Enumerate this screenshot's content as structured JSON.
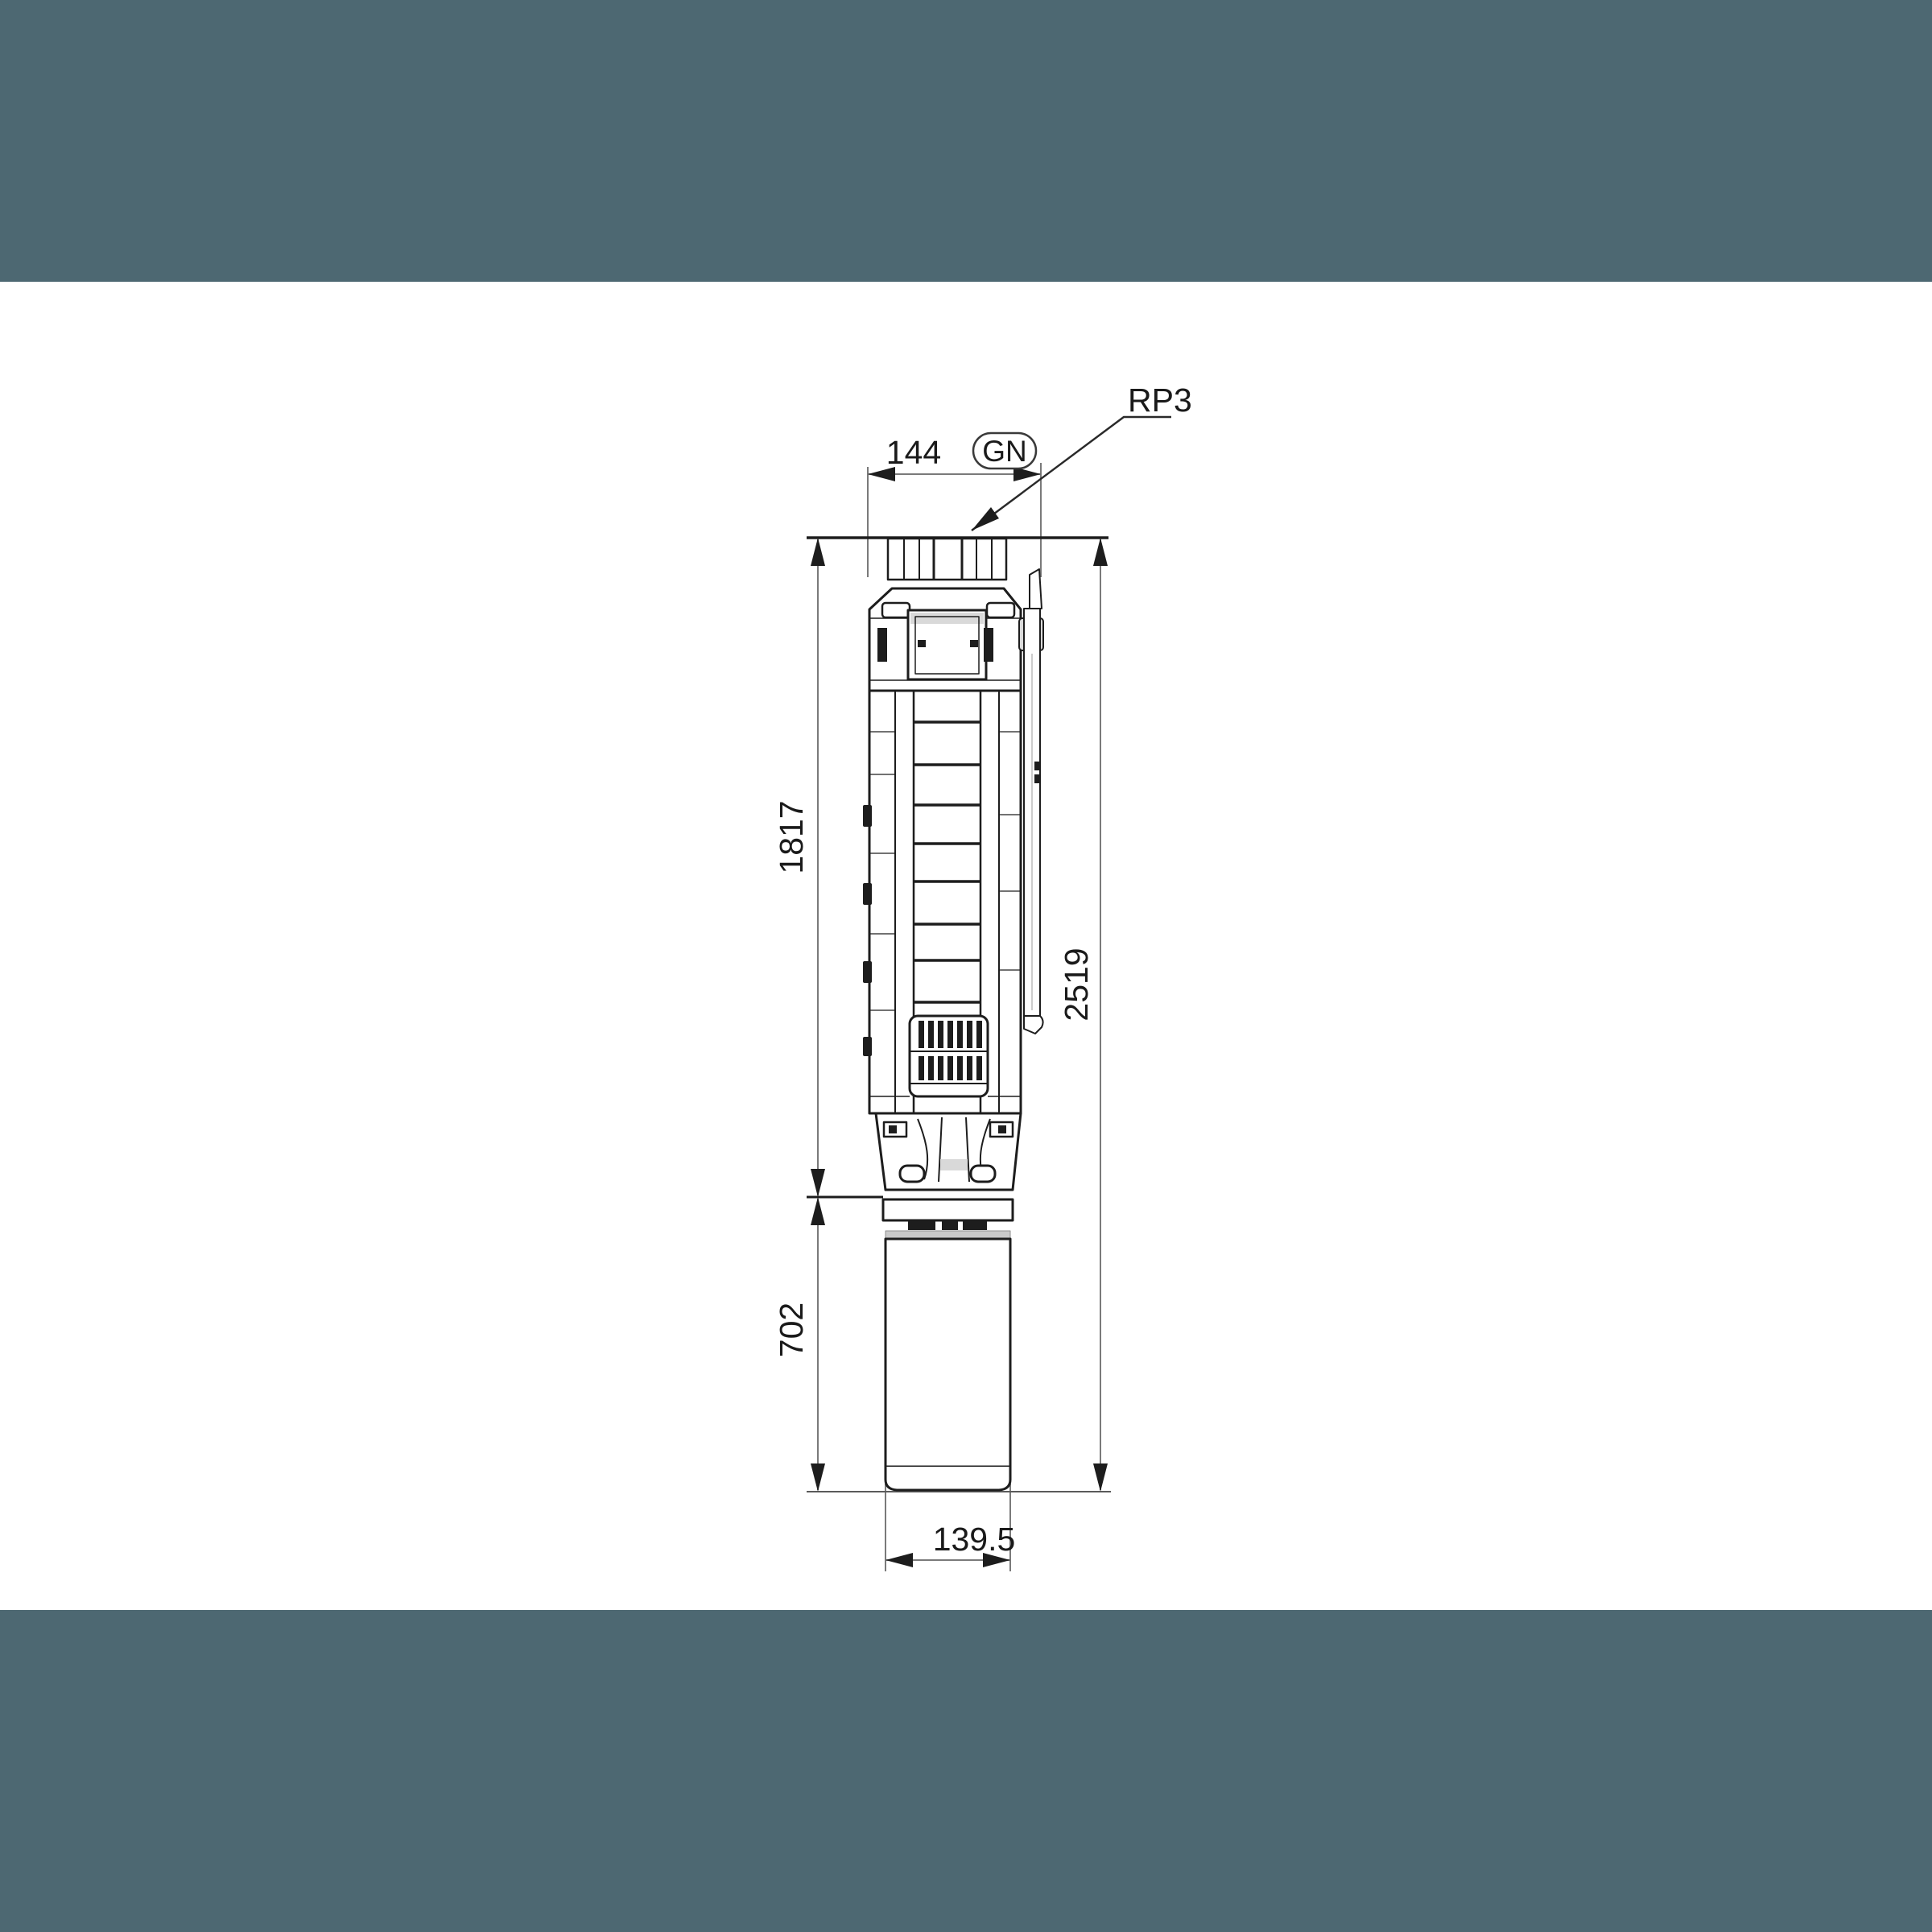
{
  "page": {
    "background": "#ffffff",
    "band_color": "#4d6872"
  },
  "drawing": {
    "title": "Submersible pump dimensional drawing",
    "colors": {
      "line": "#1d1d1d",
      "dimension_line": "#7a7a7a",
      "baseline": "#5a5a5a",
      "shade": "#d9d9d9",
      "motor_band": "#c9c9c9"
    },
    "labels": {
      "top_width": "144",
      "outlet_badge": "GN",
      "thread_callout": "RP3",
      "pump_length": "1817",
      "motor_length": "702",
      "total_length": "2519",
      "bottom_diameter": "139.5"
    }
  }
}
